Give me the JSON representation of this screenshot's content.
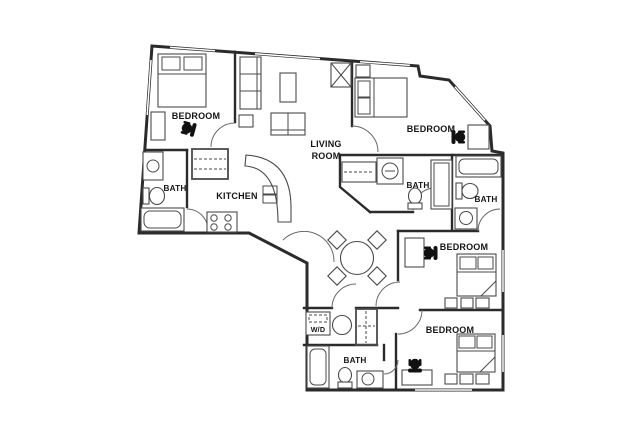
{
  "canvas": {
    "width": 640,
    "height": 432,
    "background": "#ffffff"
  },
  "floorplan": {
    "name": "apartment-floor-plan",
    "colors": {
      "wall": "#2b2b2b",
      "furniture": "#4a4a4a",
      "label": "#151515"
    },
    "labels": {
      "bedroom_top_left": "BEDROOM",
      "bath_top_left": "BATH",
      "kitchen": "KITCHEN",
      "living_line1": "LIVING",
      "living_line2": "ROOM",
      "bedroom_top_right": "BEDROOM",
      "bath_middle": "BATH",
      "bath_right": "BATH",
      "bedroom_mid_right": "BEDROOM",
      "bedroom_bottom": "BEDROOM",
      "bath_bottom": "BATH",
      "washer_dryer": "W/D"
    }
  }
}
